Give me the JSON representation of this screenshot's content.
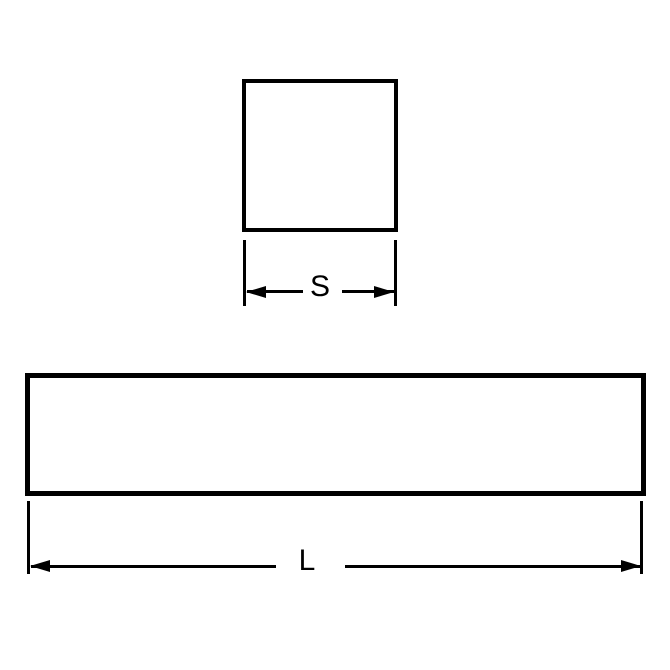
{
  "background_color": "#ffffff",
  "line_color": "#000000",
  "figures": {
    "square_section": {
      "shape": "square-outline",
      "dimension_label": "S"
    },
    "length_bar": {
      "shape": "rectangle-outline",
      "dimension_label": "L"
    }
  },
  "icons": [
    "arrow-left-icon",
    "arrow-right-icon"
  ]
}
